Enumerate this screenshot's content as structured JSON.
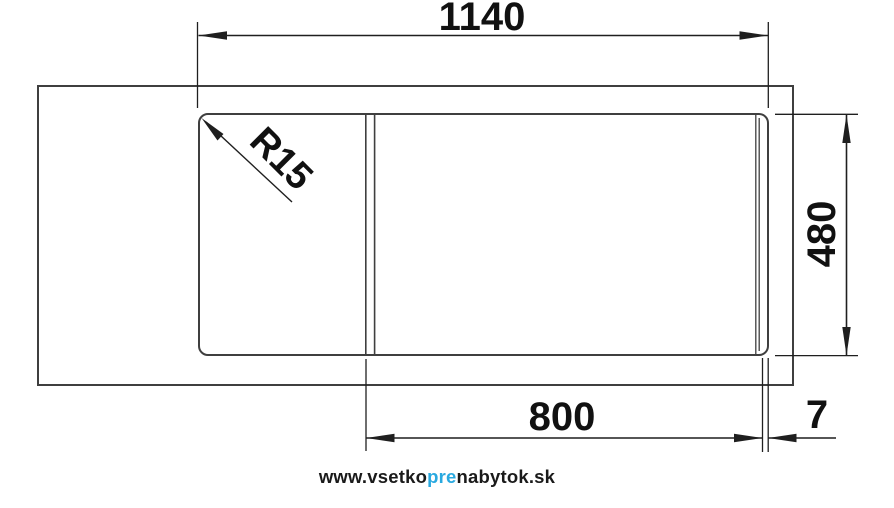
{
  "page": {
    "background": "#ffffff"
  },
  "drawing": {
    "type": "sink-dimension-diagram",
    "labels": {
      "overall_width": "1140",
      "overall_depth": "480",
      "bowl_width": "800",
      "rim_offset": "7",
      "corner_radius": "R15"
    },
    "colors": {
      "outline": "#3f3f3f",
      "dimension_line": "#1f1f1f",
      "label_text": "#111111"
    }
  },
  "watermark": {
    "prefix": "www.vsetko",
    "highlight": "pre",
    "suffix": "nabytok.sk",
    "highlight_color": "#29a9e0",
    "text_color": "#1a1a1a"
  }
}
